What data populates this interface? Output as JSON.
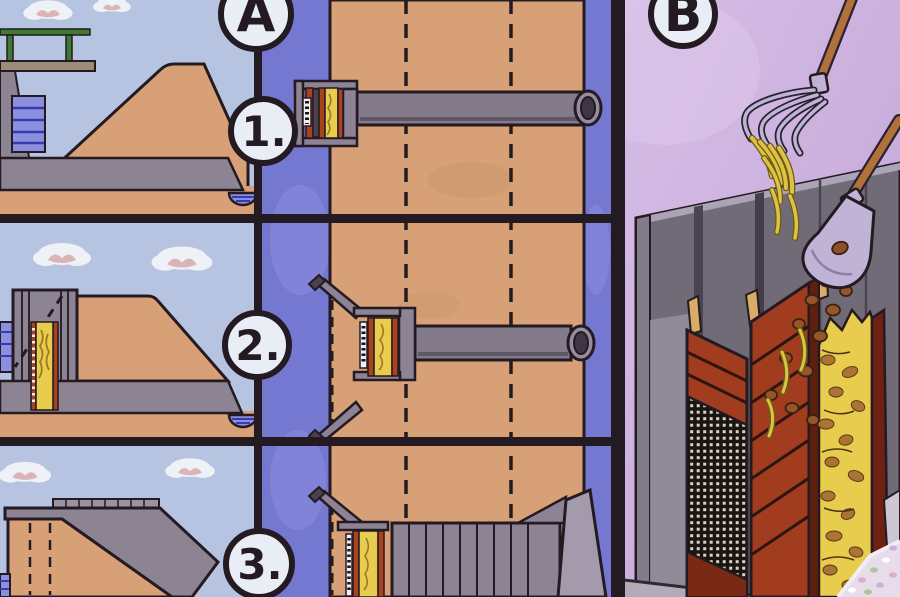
{
  "poster": {
    "section_a": {
      "label": "A",
      "steps": [
        {
          "label": "1."
        },
        {
          "label": "2."
        },
        {
          "label": "3."
        }
      ]
    },
    "section_b": {
      "label": "B"
    }
  },
  "icons": {
    "pitchfork": "pitchfork-icon",
    "shovel": "shovel-icon",
    "cloud": "cloud-icon"
  },
  "colors": {
    "sky": "#b7c4e1",
    "panel-blue": "#7578d0",
    "heap-tan": "#d7a077",
    "outline": "#241a22",
    "straw-yellow": "#e7cc4e",
    "machine-gray": "#8d8395",
    "band-gray": "#8c8492",
    "wall-gray": "#716b78",
    "bin-red": "#a23c1e",
    "b-bg": "#c2a3d5",
    "b-bg-light": "#d6bee6",
    "metal": "#bfb3d6",
    "handle-brown": "#b0713a",
    "pond-blue": "#8a90dd",
    "stake-tan": "#d9ad66",
    "badge-bg": "#e9edf5"
  }
}
